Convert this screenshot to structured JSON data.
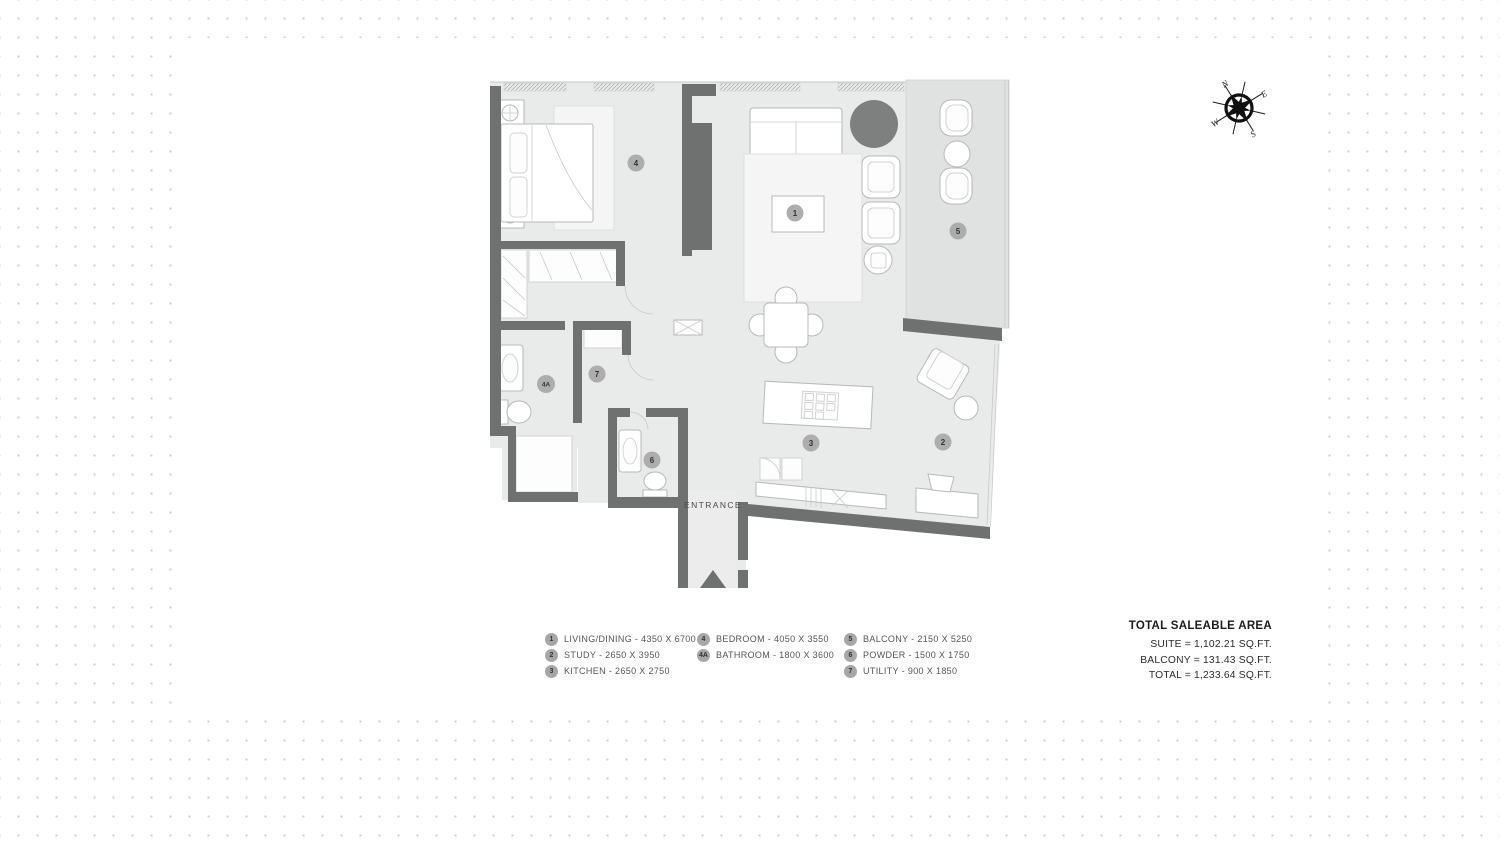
{
  "compass": {
    "n": "N",
    "e": "E",
    "s": "S",
    "w": "W"
  },
  "floor_plan": {
    "entrance_label": "ENTRANCE",
    "markers": [
      {
        "id": "1"
      },
      {
        "id": "2"
      },
      {
        "id": "3"
      },
      {
        "id": "4"
      },
      {
        "id": "4A"
      },
      {
        "id": "5"
      },
      {
        "id": "6"
      },
      {
        "id": "7"
      }
    ]
  },
  "legend": {
    "columns": [
      {
        "items": [
          {
            "marker": "1",
            "label": "LIVING/DINING - 4350 X 6700"
          },
          {
            "marker": "2",
            "label": "STUDY - 2650 X 3950"
          },
          {
            "marker": "3",
            "label": "KITCHEN - 2650 X 2750"
          }
        ]
      },
      {
        "items": [
          {
            "marker": "4",
            "label": "BEDROOM - 4050 X 3550"
          },
          {
            "marker": "4A",
            "label": "BATHROOM - 1800 X 3600"
          }
        ]
      },
      {
        "items": [
          {
            "marker": "5",
            "label": "BALCONY - 2150 X 5250"
          },
          {
            "marker": "6",
            "label": "POWDER - 1500 X 1750"
          },
          {
            "marker": "7",
            "label": "UTILITY - 900 X 1850"
          }
        ]
      }
    ]
  },
  "totals": {
    "title": "TOTAL SALEABLE AREA",
    "lines": [
      "SUITE = 1,102.21 SQ.FT.",
      "BALCONY = 131.43 SQ.FT.",
      "TOTAL = 1,233.64 SQ.FT."
    ]
  },
  "colors": {
    "wall": "#6f7070",
    "floor": "#e9eaea",
    "balcony": "#e0e1e1",
    "darkcircle": "#7e7f7f",
    "markerbg": "#a7a7a7",
    "dot": "#cfcfcf"
  }
}
